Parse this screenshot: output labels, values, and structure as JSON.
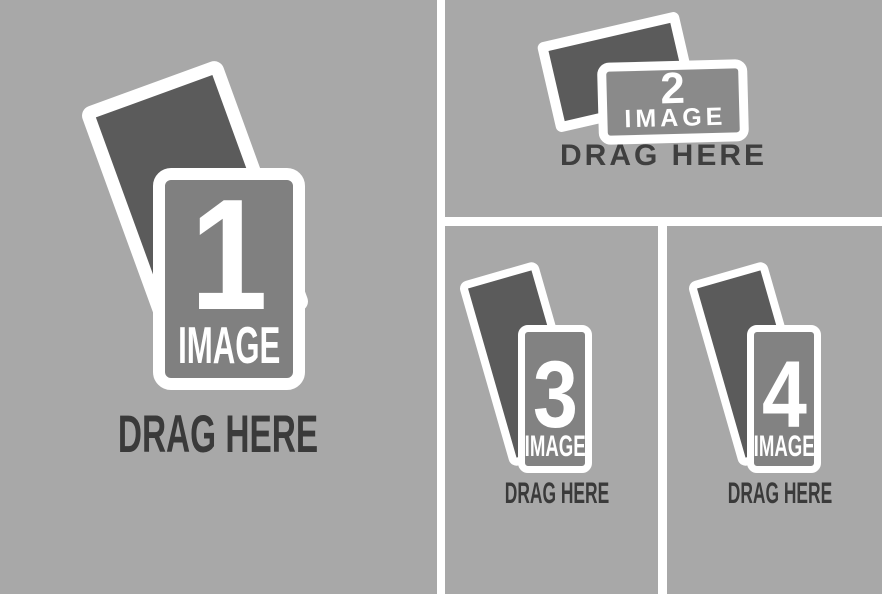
{
  "colors": {
    "zone_background": "#a8a8a8",
    "divider": "#ffffff",
    "photo_back_frame": "#5b5b5b",
    "photo_front_frame_1": "#808080",
    "photo_front_frame_2": "#8a8a8a",
    "photo_front_frame_3_4": "#828282",
    "drag_here_text": "#3a3a3a",
    "frame_label_text": "#ffffff"
  },
  "zones": [
    {
      "id": "zone-1",
      "number": "1",
      "image_label": "IMAGE",
      "drag_label": "DRAG HERE"
    },
    {
      "id": "zone-2",
      "number": "2",
      "image_label": "IMAGE",
      "drag_label": "DRAG HERE"
    },
    {
      "id": "zone-3",
      "number": "3",
      "image_label": "IMAGE",
      "drag_label": "DRAG HERE"
    },
    {
      "id": "zone-4",
      "number": "4",
      "image_label": "IMAGE",
      "drag_label": "DRAG HERE"
    }
  ]
}
